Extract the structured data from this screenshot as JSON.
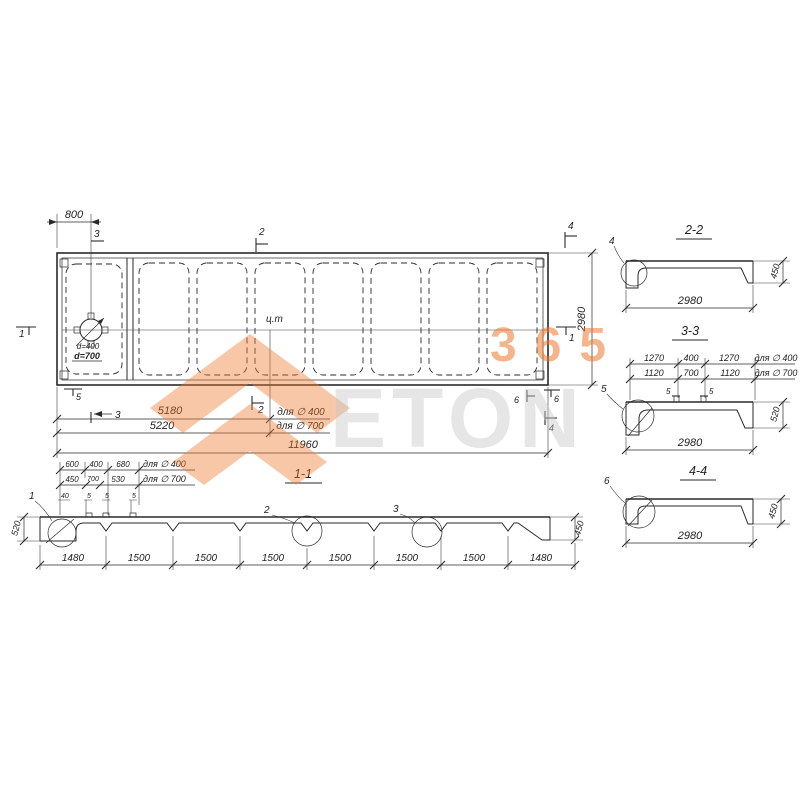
{
  "drawing": {
    "ink": "#2a2a2a",
    "plan": {
      "dim_top": "800",
      "marker_top_3": "3",
      "marker_top_2": "2",
      "marker_top_4": "4",
      "marker_left_1": "1",
      "marker_right_1": "1",
      "marker_bottom_5": "5",
      "marker_bottom_3": "3",
      "marker_bottom_2": "2",
      "marker_bottom_6a": "6",
      "marker_bottom_6b": "6",
      "marker_bottom_4": "4",
      "cg": "ц.т",
      "hole_label_400": "d=400",
      "hole_label_700": "d=700",
      "dim_5180": "5180",
      "dim_5180_label": "для ∅ 400",
      "dim_5220": "5220",
      "dim_5220_label": "для ∅ 700",
      "dim_total": "11960",
      "dim_height": "2980"
    },
    "s11": {
      "title": "1-1",
      "rowA": [
        "600",
        "400",
        "680"
      ],
      "rowA_label": "для ∅ 400",
      "rowB": [
        "450",
        "700",
        "530"
      ],
      "rowB_label": "для ∅ 700",
      "rowC": [
        "40",
        "5",
        "5",
        "5"
      ],
      "left_h": "520",
      "right_h": "450",
      "bottom": [
        "1480",
        "1500",
        "1500",
        "1500",
        "1500",
        "1500",
        "1500",
        "1480"
      ],
      "d1": "1",
      "d2": "2",
      "d3": "3"
    },
    "s22": {
      "title": "2-2",
      "detail": "4",
      "w": "2980",
      "h": "450"
    },
    "s33": {
      "title": "3-3",
      "row1": [
        "1270",
        "400",
        "1270"
      ],
      "row1_label": "для ∅ 400",
      "row2": [
        "1120",
        "700",
        "1120"
      ],
      "row2_label": "для ∅ 700",
      "small1": "5",
      "small2": "5",
      "detail": "5",
      "w": "2980",
      "h": "520"
    },
    "s44": {
      "title": "4-4",
      "detail": "6",
      "w": "2980",
      "h": "450"
    }
  },
  "watermark": {
    "digits": "365",
    "letters": "ETON",
    "orange": "#ee7a2f",
    "gray": "#c8c8c8"
  }
}
